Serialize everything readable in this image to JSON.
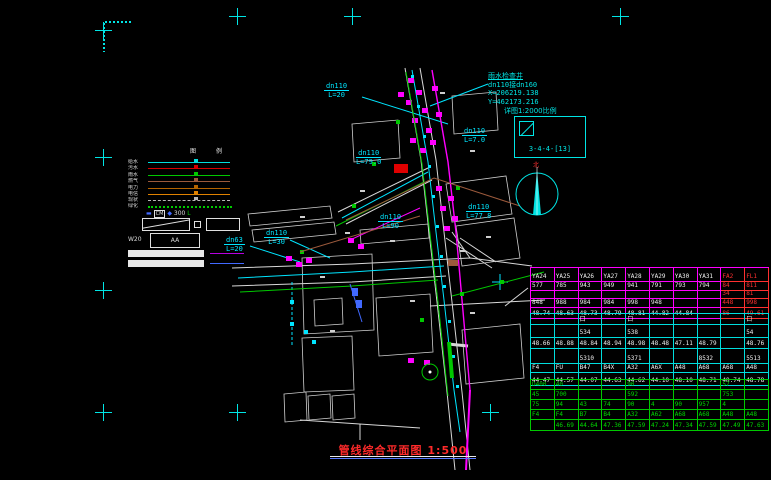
{
  "drawing": {
    "title": {
      "text": "管线综合平面图",
      "scale": "1:500"
    },
    "north_label": "北",
    "detail": {
      "caption": "详图1:2000比例",
      "label": "3-4-4-[13]"
    },
    "annotation": {
      "lines": [
        "雨水检查井",
        "dn110接dn160",
        "X=206219.138",
        "Y=462173.216"
      ]
    },
    "pipe_labels": [
      {
        "size": "dn110",
        "len": "L=20",
        "x": 324,
        "y": 82
      },
      {
        "size": "dn110",
        "len": "L=79.0",
        "x": 356,
        "y": 149
      },
      {
        "size": "dn110",
        "len": "L=7.0",
        "x": 462,
        "y": 127
      },
      {
        "size": "dn110",
        "len": "L=77.8",
        "x": 466,
        "y": 203
      },
      {
        "size": "dn110",
        "len": "L=90",
        "x": 378,
        "y": 213
      },
      {
        "size": "dn110",
        "len": "L=30",
        "x": 264,
        "y": 229
      },
      {
        "size": "dn63",
        "len": "L=20",
        "x": 224,
        "y": 236
      }
    ],
    "legend": {
      "header": [
        "图",
        "例"
      ],
      "items": [
        {
          "label": "给水",
          "color": "#00dede",
          "dash": false
        },
        {
          "label": "污水",
          "color": "#d40000",
          "dash": false
        },
        {
          "label": "雨水",
          "color": "#00c800",
          "dash": false
        },
        {
          "label": "燃气",
          "color": "#9c5a3c",
          "dash": false
        },
        {
          "label": "电力",
          "color": "#b46400",
          "dash": false
        },
        {
          "label": "电信",
          "color": "#e08200",
          "dash": false
        },
        {
          "label": "现状",
          "color": "#b8b8b8",
          "dash": true
        }
      ],
      "dotted_label": "绿化",
      "symbol_row": [
        "▬",
        "CM",
        "◆",
        "300",
        "L"
      ],
      "w_label": "W20",
      "box_label": "AA"
    },
    "table": {
      "sections": [
        {
          "color": "#ff00ff",
          "text": "#f0f0f0",
          "red": "#ff3030",
          "red_cols": [
            8,
            9
          ],
          "top": 267,
          "row_heights": [
            13,
            8,
            7,
            8,
            10
          ],
          "rows": [
            [
              "YA24",
              "YA25",
              "YA26",
              "YA27",
              "YA28",
              "YA29",
              "YA30",
              "YA31",
              "FA2",
              "FL1"
            ],
            [
              "577",
              "785",
              "943",
              "949",
              "941",
              "791",
              "793",
              "794",
              "84",
              "811"
            ],
            [
              "",
              "",
              "",
              "",
              "",
              "",
              "",
              "",
              "34",
              "81"
            ],
            [
              "848",
              "988",
              "984",
              "984",
              "998",
              "948",
              "",
              "",
              "448",
              "998"
            ],
            [
              "48.74",
              "48.63",
              "48.73",
              "48.79",
              "48.81",
              "44.82",
              "44.84",
              "",
              "86",
              "49.61"
            ]
          ]
        },
        {
          "color": "#00dede",
          "text": "#f0f0f0",
          "red": "#00dede",
          "red_cols": [],
          "top": 313,
          "row_heights": [
            10,
            12,
            10,
            14,
            8,
            12
          ],
          "rows": [
            [
              "",
              "",
              "口",
              "",
              "口",
              "",
              "",
              "",
              "",
              "口"
            ],
            [
              "",
              "",
              "534",
              "",
              "538",
              "",
              "",
              "",
              "",
              "54"
            ],
            [
              "48.66",
              "48.88",
              "48.84",
              "48.94",
              "48.98",
              "48.48",
              "47.11",
              "48.79",
              "",
              "48.76"
            ],
            [
              "",
              "",
              "5310",
              "",
              "5371",
              "",
              "",
              "8532",
              "",
              "5513"
            ],
            [
              "F4",
              "FU",
              "B47",
              "B4X",
              "A32",
              "A6X",
              "A48",
              "A68",
              "A68",
              "A48"
            ],
            [
              "44.47",
              "44.57",
              "44.07",
              "44.63",
              "44.62",
              "44.10",
              "48.10",
              "48.71",
              "48.74",
              "48.78"
            ]
          ]
        },
        {
          "color": "#00c800",
          "text": "#00d800",
          "red": "#00c800",
          "red_cols": [],
          "top": 379,
          "row_heights": [
            9,
            9,
            9,
            9,
            10
          ],
          "rows": [
            [
              "D400",
              "40",
              "",
              "",
              "90",
              "",
              "",
              "",
              "57",
              ""
            ],
            [
              "45",
              "700",
              "",
              "",
              "592",
              "",
              "",
              "",
              "753",
              ""
            ],
            [
              "75",
              "94",
              "43",
              "74",
              "90",
              "4",
              "90",
              "957",
              "4",
              ""
            ],
            [
              "F4",
              "F4",
              "B7",
              "B4",
              "A32",
              "A62",
              "A68",
              "A68",
              "A48",
              "A48"
            ],
            [
              "",
              "46.69",
              "44.64",
              "47.36",
              "47.59",
              "47.24",
              "47.34",
              "47.59",
              "47.49",
              "47.63"
            ]
          ]
        }
      ]
    }
  }
}
